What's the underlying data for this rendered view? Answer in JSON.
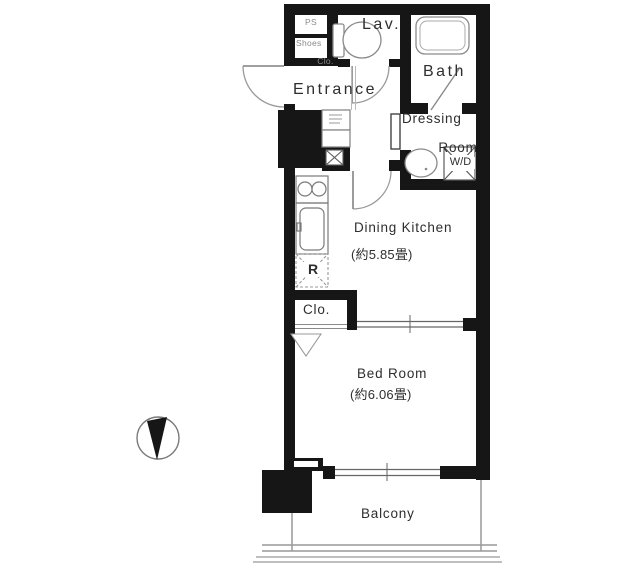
{
  "floor_plan": {
    "rooms": {
      "ps": {
        "label": "PS"
      },
      "shoes_closet": {
        "line1": "Shoes",
        "line2": "Clo."
      },
      "lavatory": {
        "label": "Lav."
      },
      "bath": {
        "label": "Bath"
      },
      "entrance": {
        "label": "Entrance"
      },
      "dressing_room": {
        "line1": "Dressing",
        "line2": "Room"
      },
      "washer_dryer": {
        "label": "W/D"
      },
      "dining_kitchen": {
        "label": "Dining Kitchen",
        "size": "(約5.85畳)"
      },
      "refrigerator_space": {
        "label": "R"
      },
      "closet": {
        "label": "Clo."
      },
      "bedroom": {
        "label": "Bed Room",
        "size": "(約6.06畳)"
      },
      "balcony": {
        "label": "Balcony"
      }
    },
    "icons": {
      "compass": "north-arrow",
      "fixtures": [
        "toilet",
        "bathtub",
        "wash-basin",
        "stove-2-burner",
        "kitchen-sink",
        "washer-pan",
        "meter-box",
        "door-swing",
        "sliding-window"
      ]
    },
    "colors": {
      "wall": "#161616",
      "fixture_line": "#888888",
      "text": "#2e2e2e",
      "background": "#ffffff"
    }
  }
}
